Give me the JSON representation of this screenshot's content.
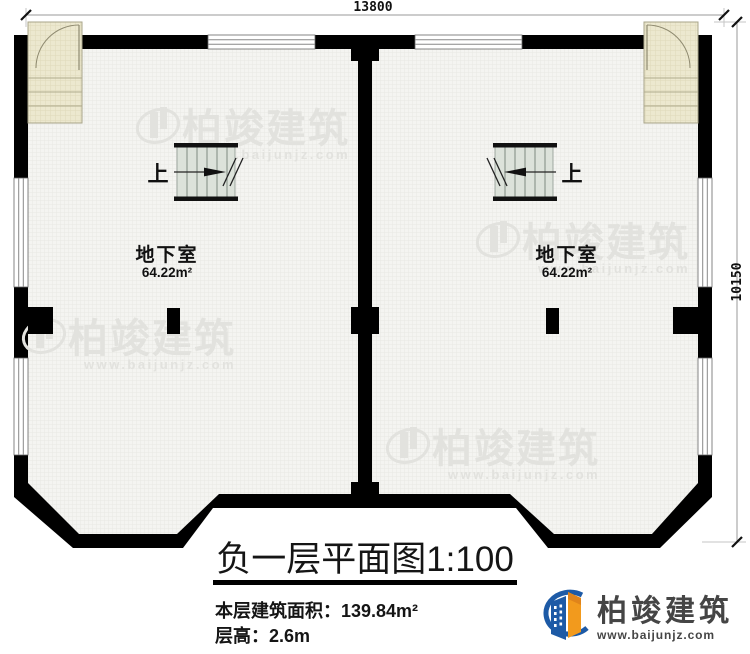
{
  "plan": {
    "dim_top": "13800",
    "dim_right": "10150",
    "rooms": [
      {
        "name": "地下室",
        "area": "64.22m²",
        "stair_label": "上"
      },
      {
        "name": "地下室",
        "area": "64.22m²",
        "stair_label": "上"
      }
    ]
  },
  "watermark": {
    "brand": "柏竣建筑",
    "url": "www.baijunjz.com"
  },
  "title_block": {
    "title": "负一层平面图1:100",
    "area_label": "本层建筑面积：",
    "area_value": "139.84m²",
    "floor_height_label": "层高：",
    "floor_height_value": "2.6m"
  },
  "logo": {
    "brand": "柏竣建筑",
    "url": "www.baijunjz.com"
  },
  "colors": {
    "wall": "#000000",
    "floor": "#f4f4f1",
    "exterior_stair": "#ece8cf",
    "interior_stair": "#dce2da",
    "watermark": "#e2e2de",
    "logo_blue": "#1d5aa6",
    "logo_orange": "#f29a1d",
    "logo_text": "#454545"
  }
}
